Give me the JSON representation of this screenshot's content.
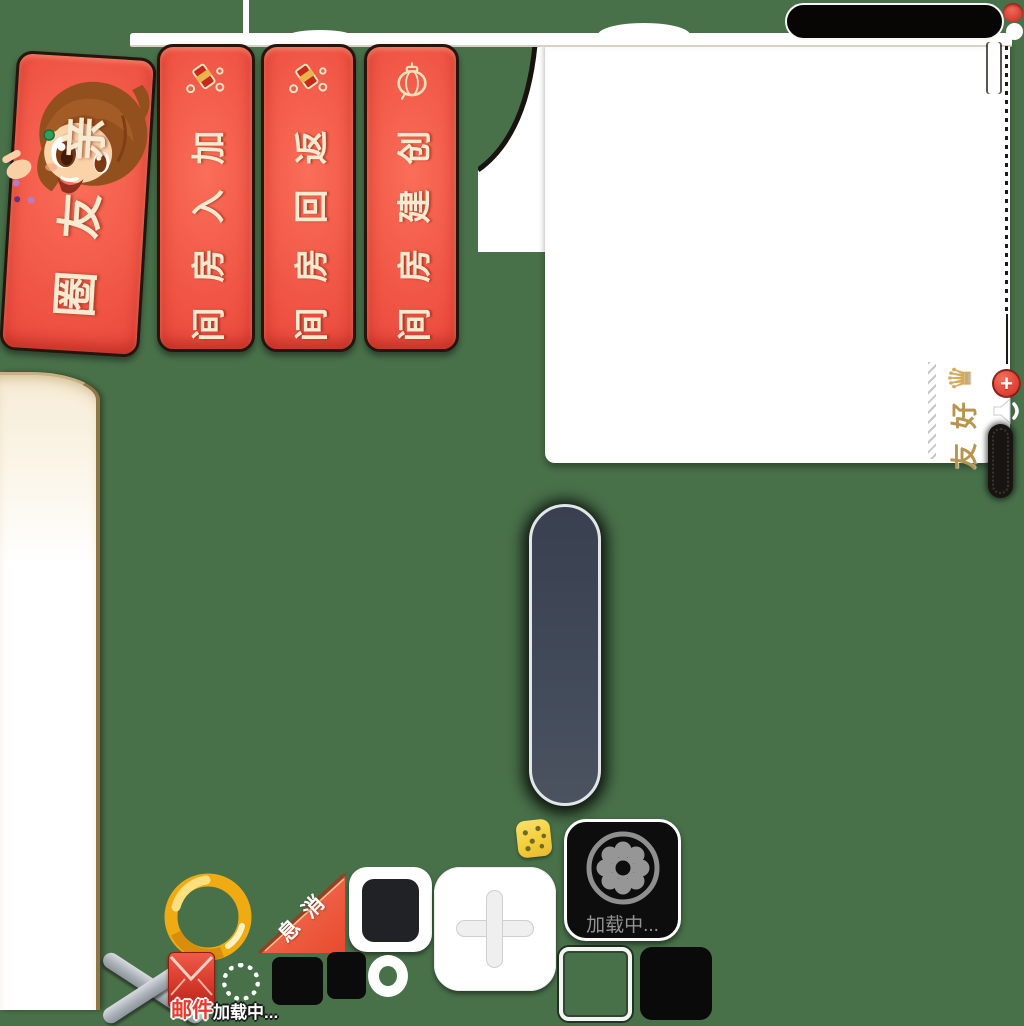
{
  "colors": {
    "background": "#487049",
    "banner_red": "#ee4a3e",
    "banner_text_cream": "#f6ead0",
    "gold_ring": "#f1ab12",
    "panel_white": "#ffffff",
    "slate_bar": "#414a59",
    "toast_text_gray": "#939393",
    "mail_red": "#e93a2c",
    "friends_tab_gold": "#b9944d"
  },
  "banners": {
    "friend_circle": "亲友圈",
    "join_room": "加入房间",
    "return_room": "返回房间",
    "create_room": "创建房间"
  },
  "friends_panel": {
    "tab": "好友"
  },
  "corner_ribbon": "消息",
  "loading_toast": "加载中...",
  "loading_small": "加载中...",
  "mail_label": "邮件",
  "plus_glyph": "+",
  "crown_glyph": "♛",
  "icons": {
    "girl_mascot": "girl-mascot-art",
    "firecracker": "firecracker-icon",
    "lantern": "lantern-icon",
    "crown": "crown-icon",
    "speaker": "speaker-icon",
    "add": "plus-icon",
    "flower_wheel": "flower-wheel-loading-icon",
    "dice": "dice-icon",
    "close": "close-icon",
    "mail": "mail-icon",
    "spinner": "dotted-spinner-icon"
  }
}
